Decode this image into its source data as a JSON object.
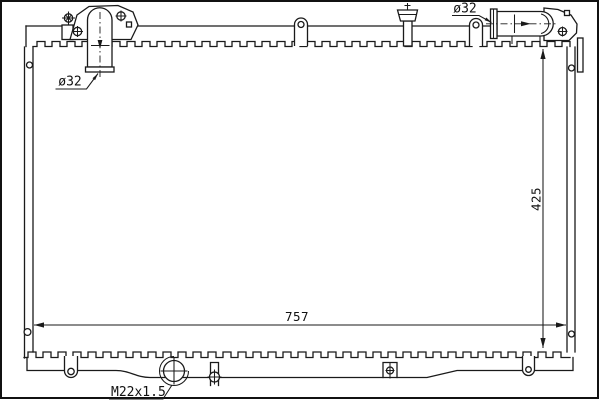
{
  "drawing": {
    "labels": {
      "inlet_pipe_diameter": "ø32",
      "outlet_pipe_diameter": "ø32",
      "core_width": "757",
      "core_height": "425",
      "drain_plug_thread": "M22x1.5"
    },
    "colors": {
      "line": "#1a1a1a",
      "background": "#ffffff"
    }
  }
}
